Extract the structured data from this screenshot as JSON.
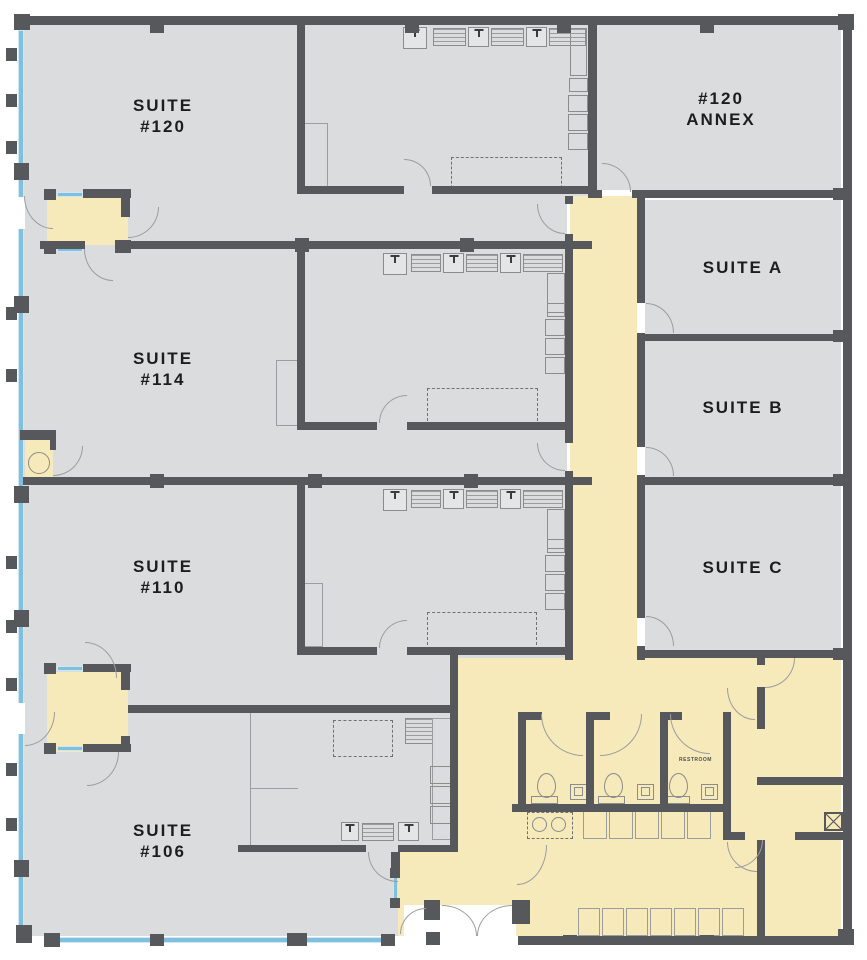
{
  "plan_type": "office-floor-plan",
  "rooms": {
    "suite120": {
      "line1": "SUITE",
      "line2": "#120"
    },
    "suite114": {
      "line1": "SUITE",
      "line2": "#114"
    },
    "suite110": {
      "line1": "SUITE",
      "line2": "#110"
    },
    "suite106": {
      "line1": "SUITE",
      "line2": "#106"
    },
    "annex120": {
      "line1": "#120",
      "line2": "ANNEX"
    },
    "suiteA": {
      "label": "SUITE A"
    },
    "suiteB": {
      "label": "SUITE B"
    },
    "suiteC": {
      "label": "SUITE C"
    },
    "restroom": {
      "label": "RESTROOM"
    }
  },
  "colors": {
    "wall": "#57585B",
    "floor": "#DBDCDD",
    "common_area": "#F6E9BA",
    "window": "#7FBFDF",
    "fixture_line": "#8A8C8E",
    "label_text": "#1D1D1F",
    "background": "#FFFFFF"
  }
}
